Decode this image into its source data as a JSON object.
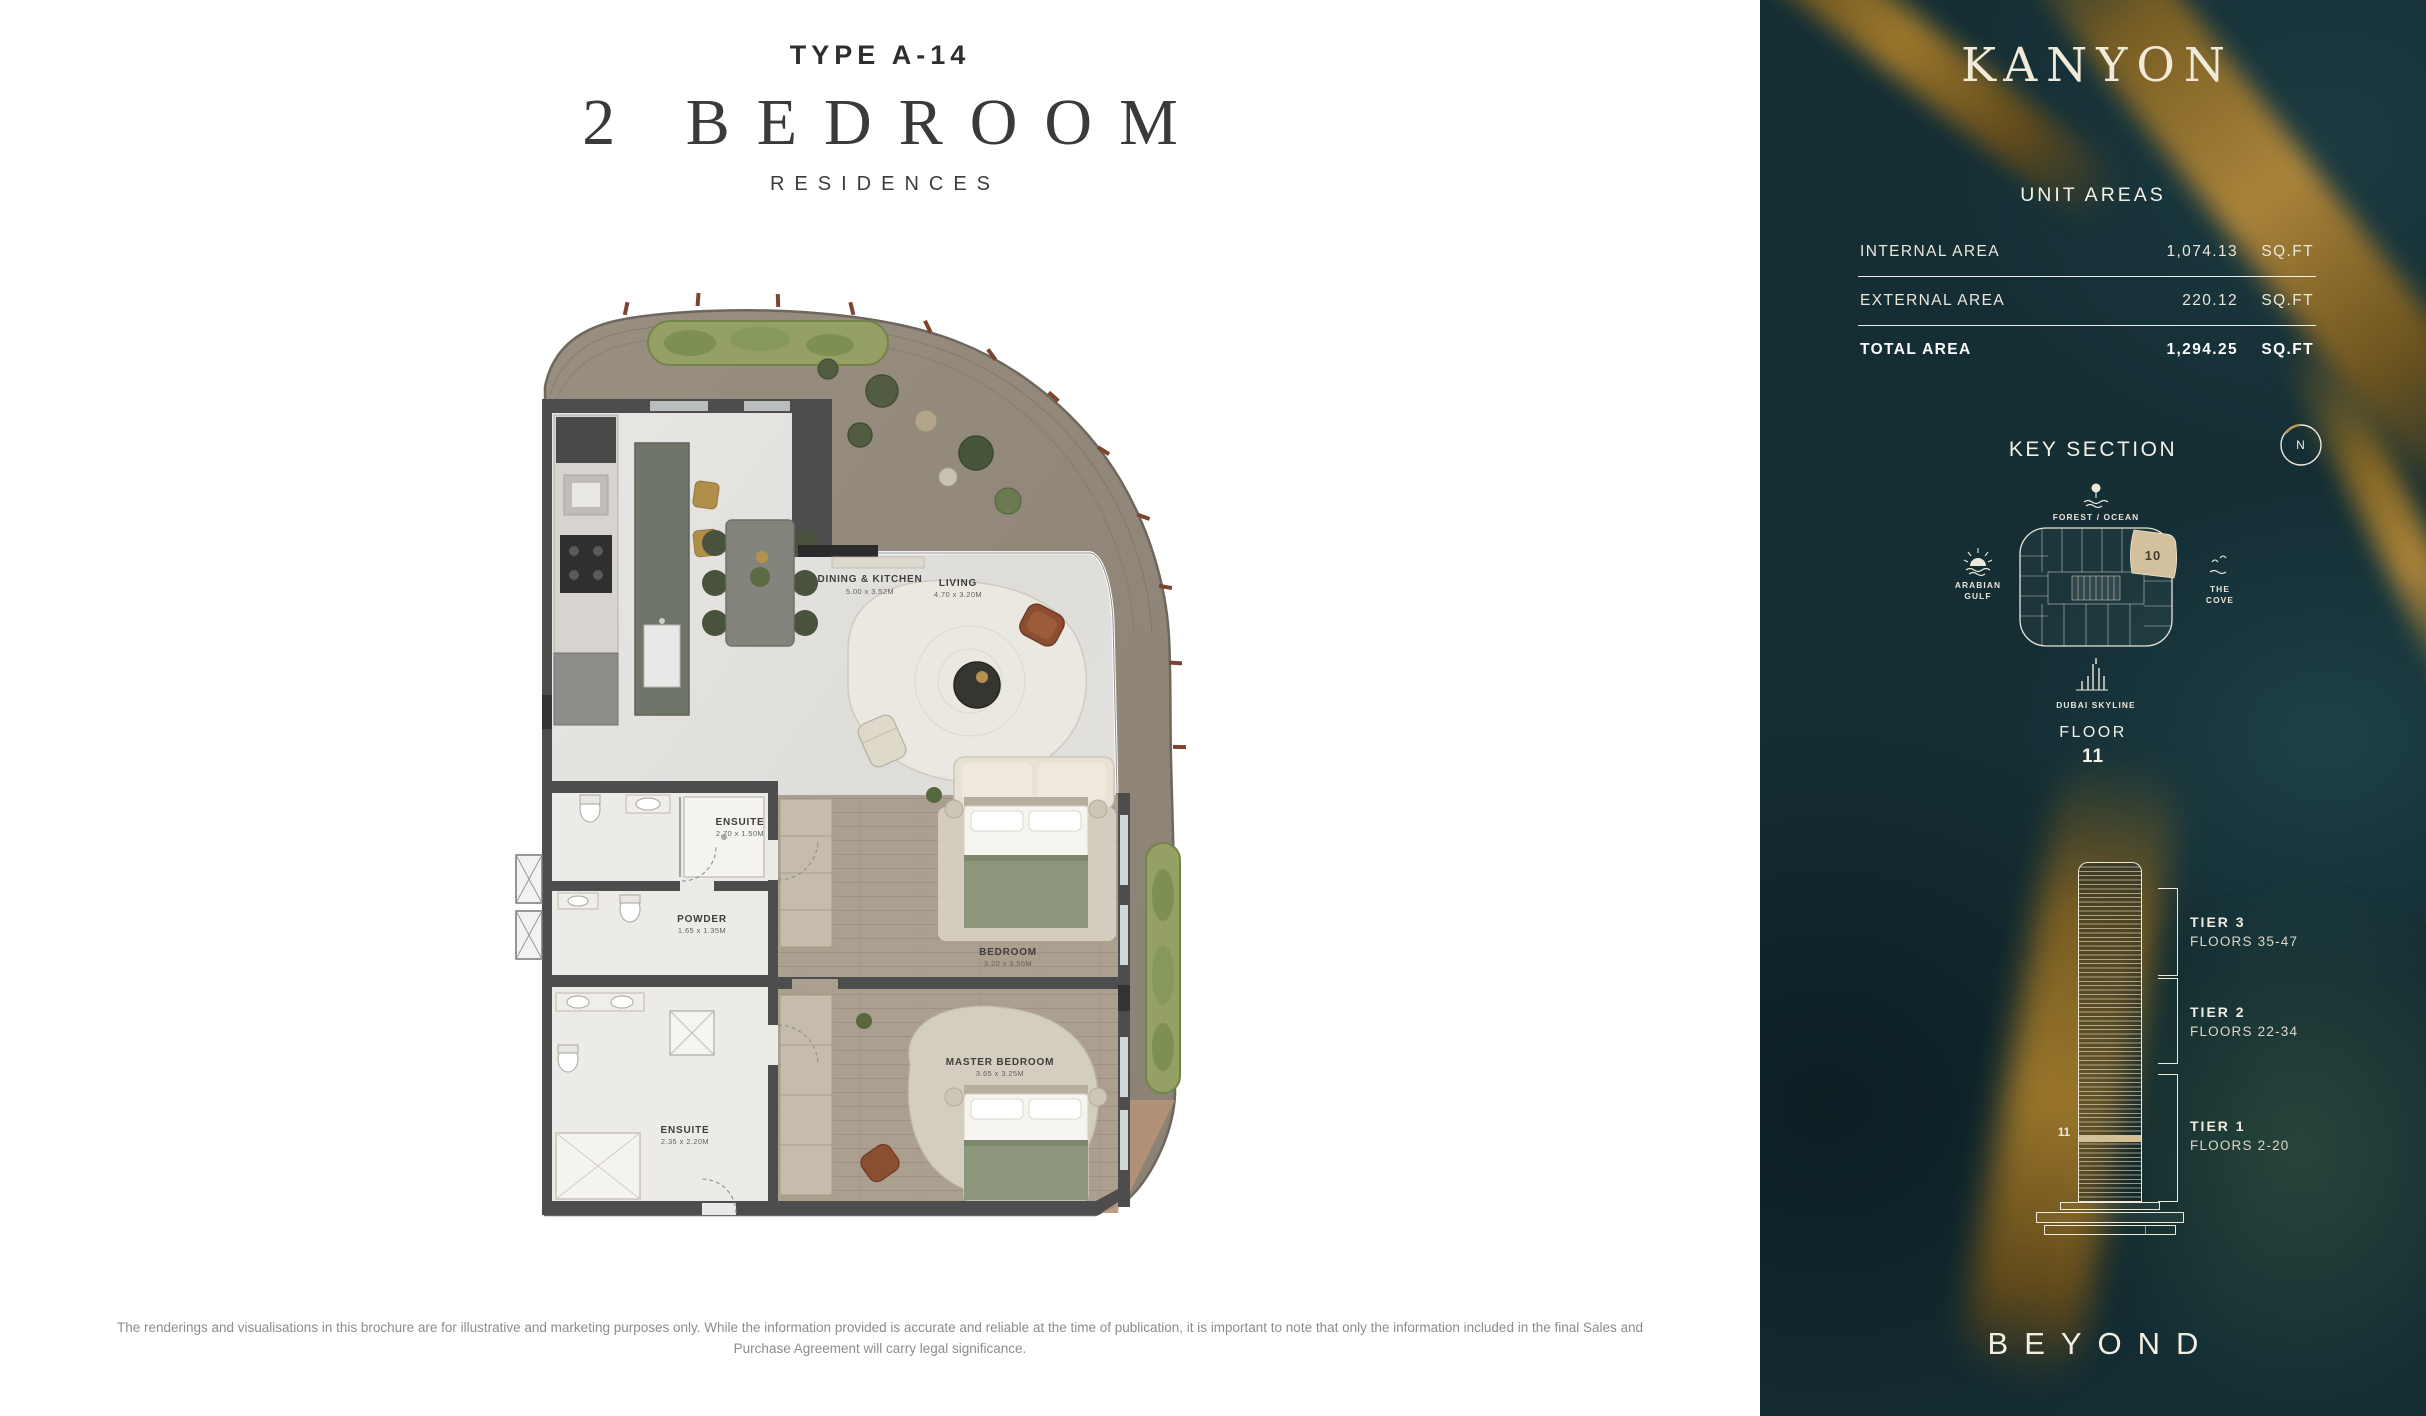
{
  "header": {
    "type": "TYPE A-14",
    "title": "2 BEDROOM",
    "subtitle": "RESIDENCES"
  },
  "floor_plan": {
    "rooms": [
      {
        "name": "DINING & KITCHEN",
        "dims": "5.00 x 3.52M"
      },
      {
        "name": "LIVING",
        "dims": "4.70 x 3.20M"
      },
      {
        "name": "ENSUITE",
        "dims": "2.70 x 1.50M"
      },
      {
        "name": "POWDER",
        "dims": "1.65 x 1.35M"
      },
      {
        "name": "BEDROOM",
        "dims": "3.20 x 3.55M"
      },
      {
        "name": "MASTER BEDROOM",
        "dims": "3.65 x 3.25M"
      },
      {
        "name": "ENSUITE",
        "dims": "2.35 x 2.20M"
      }
    ]
  },
  "sidebar": {
    "brand": "KANYON",
    "unit_areas": {
      "title": "UNIT AREAS",
      "rows": [
        {
          "label": "INTERNAL AREA",
          "value": "1,074.13",
          "unit": "SQ.FT"
        },
        {
          "label": "EXTERNAL AREA",
          "value": "220.12",
          "unit": "SQ.FT"
        },
        {
          "label": "TOTAL AREA",
          "value": "1,294.25",
          "unit": "SQ.FT"
        }
      ]
    },
    "key_section": {
      "title": "KEY SECTION",
      "compass": "N",
      "unit_number": "10",
      "top_label": "FOREST / OCEAN",
      "left_label_1": "ARABIAN",
      "left_label_2": "GULF",
      "right_label_1": "THE",
      "right_label_2": "COVE",
      "bottom_label": "DUBAI SKYLINE"
    },
    "floor": {
      "label": "FLOOR",
      "number": "11"
    },
    "tower": {
      "floor_marker": "11",
      "tiers": [
        {
          "name": "TIER 3",
          "floors": "FLOORS 35-47"
        },
        {
          "name": "TIER 2",
          "floors": "FLOORS 22-34"
        },
        {
          "name": "TIER 1",
          "floors": "FLOORS 2-20"
        }
      ]
    },
    "developer": "BEYOND"
  },
  "footer": {
    "disclaimer": "The renderings and visualisations in this brochure are for illustrative and marketing purposes only. While the information provided is accurate and reliable at the time of publication, it is important to note that only the information included in the final Sales and Purchase Agreement will carry legal significance."
  },
  "colors": {
    "panel_teal": "#142e34",
    "accent_gold": "#b3842b",
    "highlight_beige": "#d3c09c",
    "cream": "#f2ecd9"
  }
}
